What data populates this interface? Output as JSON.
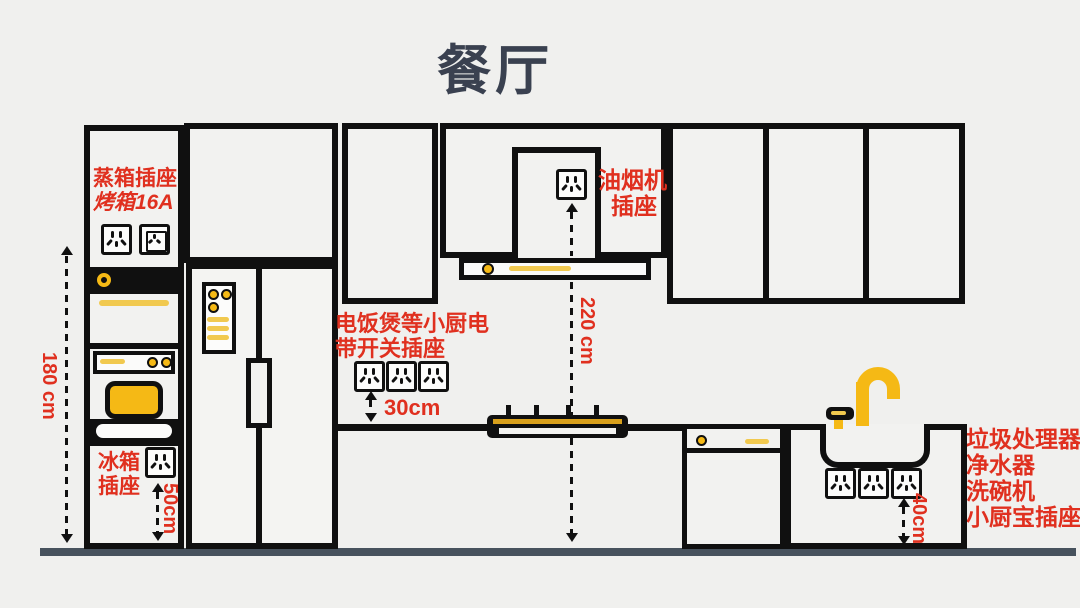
{
  "title": "餐厅",
  "labels": {
    "steam1": "蒸箱插座",
    "steam2": "烤箱16A",
    "fridge1": "冰箱",
    "fridge2": "插座",
    "small1": "电饭煲等小厨电",
    "small2": "带开关插座",
    "hood1": "油烟机",
    "hood2": "插座",
    "sink1": "垃圾处理器",
    "sink2": "净水器",
    "sink3": "洗碗机",
    "sink4": "小厨宝插座"
  },
  "measurements": {
    "m180": "180 cm",
    "m50": "50cm",
    "m30": "30cm",
    "m220": "220 cm",
    "m40": "40cm"
  },
  "colors": {
    "accent_red": "#E0301F",
    "accent_gold": "#F5B915",
    "line_ink": "#101010",
    "floor": "#47525D",
    "background": "#F0F0EE",
    "title": "#3A4150"
  }
}
